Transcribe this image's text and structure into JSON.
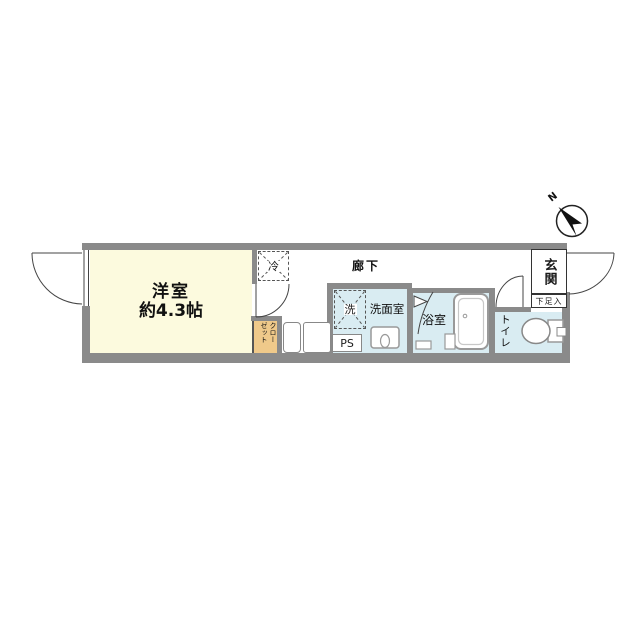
{
  "floorplan": {
    "rooms": {
      "main_room": {
        "name": "洋室",
        "size": "約4.3帖"
      },
      "hallway": {
        "label": "廊下"
      },
      "washroom": {
        "label": "洗面室"
      },
      "bathroom": {
        "label": "浴室"
      },
      "toilet": {
        "label": "トイレ"
      },
      "entrance": {
        "label": "玄関"
      },
      "shoe_cabinet": {
        "label": "下足入"
      },
      "closet": {
        "label": "クローゼット"
      },
      "refrigerator_space": {
        "label": "冷"
      },
      "washer_space": {
        "label": "洗"
      },
      "pipe_space": {
        "label": "PS"
      }
    },
    "compass": {
      "north_label": "N"
    },
    "colors": {
      "wall": "#8a8a8a",
      "main_room_fill": "#fcfade",
      "wet_area_fill": "#d9ecf2",
      "closet_fill": "#efc98a",
      "line": "#444444"
    }
  }
}
